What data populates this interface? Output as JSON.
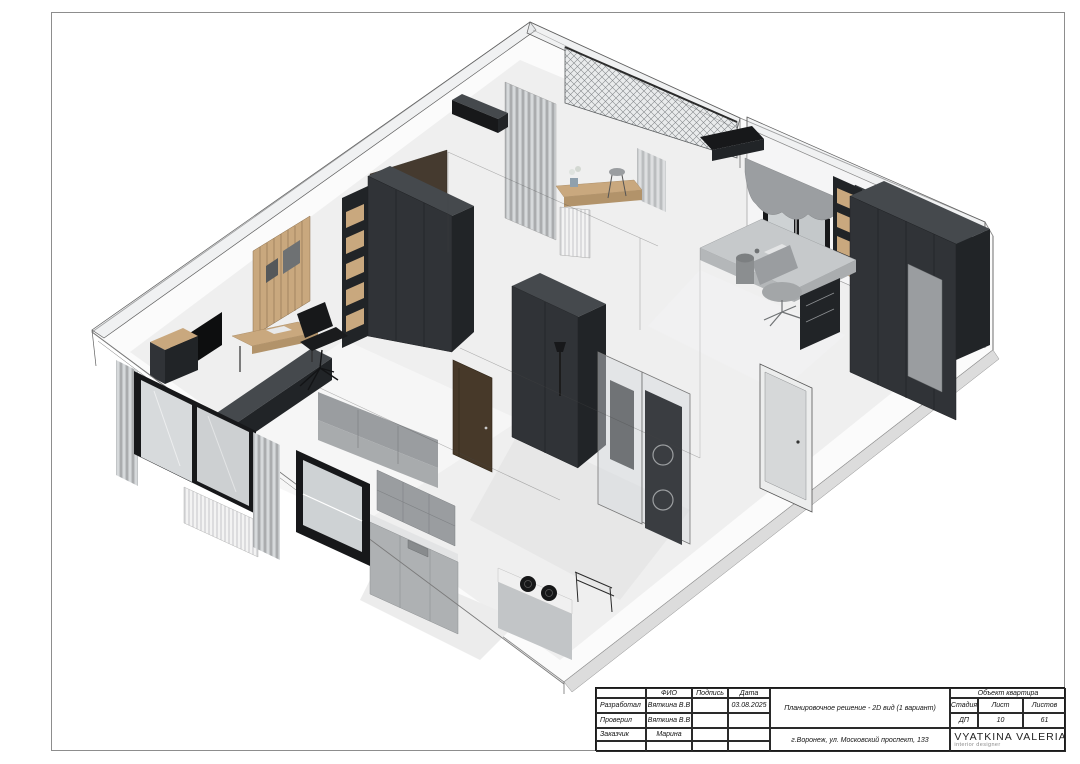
{
  "palette": {
    "white": "#FFFFFF",
    "frame": "#8D8D8D",
    "line": "#5A5A5A",
    "wood": "#C9A87E",
    "wood_dark": "#B2936A",
    "furniture_dark": "#303337",
    "furniture_darker": "#212427",
    "furniture_top": "#45494D",
    "black": "#17181A",
    "brown_door": "#473929",
    "accent_brown_wall": "#453A2F",
    "wall_white": "#F5F5F6",
    "glass": "#CED2D4",
    "glass_light": "#D9DCDE",
    "floor": "#EFEFEF",
    "floor_mid": "#E4E4E4",
    "slab": "#DCDCDC",
    "gray_mid": "#9A9DA0",
    "gray_soft": "#C6C9CB"
  },
  "title_block": {
    "people_table": {
      "headers": [
        "",
        "ФИО",
        "Подпись",
        "Дата"
      ],
      "rows": [
        {
          "role": "Разработал",
          "name": "Вяткина В.В",
          "signature": "",
          "date": "03.08.2025"
        },
        {
          "role": "Проверил",
          "name": "Вяткина В.В",
          "signature": "",
          "date": ""
        },
        {
          "role": "Заказчик",
          "name": "Марина",
          "signature": "",
          "date": ""
        },
        {
          "role": "",
          "name": "",
          "signature": "",
          "date": ""
        }
      ]
    },
    "project_title": "Планировочное решение - 2D вид (1 вариант)",
    "address": "г.Воронеж, ул. Московский проспект, 133",
    "object_label": "Объект  квартира",
    "stage_table": {
      "headers": [
        "Стадия",
        "Лист",
        "Листов"
      ],
      "values": [
        "ДП",
        "10",
        "61"
      ]
    },
    "logo": {
      "brand": "VYATKINA VALERIA",
      "tagline": "interior designer"
    }
  }
}
